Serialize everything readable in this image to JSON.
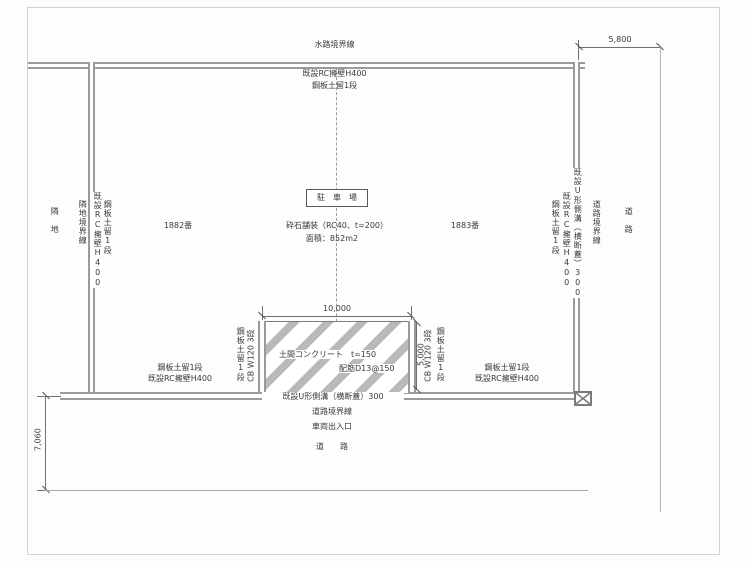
{
  "plan": {
    "top": {
      "boundary": "水路境界線",
      "wall": "既設RC擁壁H400",
      "retention": "鋼板土留1段"
    },
    "left": {
      "area": "隣　地",
      "boundary": "隣地境界線",
      "wall": "既設RC擁壁H400",
      "retention": "鋼板土留1段"
    },
    "right": {
      "retention": "鋼板土留1段",
      "wall": "既設RC擁壁H400",
      "gutter": "既設U形側溝（横断蓋）300",
      "boundary": "道路境界線",
      "area": "道　路"
    },
    "bottom": {
      "gutter": "既設U形側溝（横断蓋）300",
      "boundary": "道路境界線",
      "entrance": "車両出入口",
      "road": "道　　路"
    },
    "center": {
      "title": "駐　車　場",
      "pavement": "砕石舗装（RC40、t=200）",
      "area": "面積：852m2",
      "lot_left": "1882番",
      "lot_right": "1883番"
    },
    "pad": {
      "dim_width": "10,000",
      "dim_height": "5,000",
      "slab": "土間コンクリート　t=150",
      "rebar": "配筋D13@150",
      "left_retention": "鋼板土留1段",
      "left_cb": "CB W120 3段",
      "right_cb": "CB W120 3段",
      "right_retention": "鋼板土留1段",
      "bottom_left_retention": "鋼板土留1段",
      "bottom_left_wall": "既設RC擁壁H400",
      "bottom_right_retention": "鋼板土留1段",
      "bottom_right_wall": "既設RC擁壁H400"
    },
    "dims": {
      "bottom_road": "7,060",
      "right_road": "5,800"
    }
  }
}
